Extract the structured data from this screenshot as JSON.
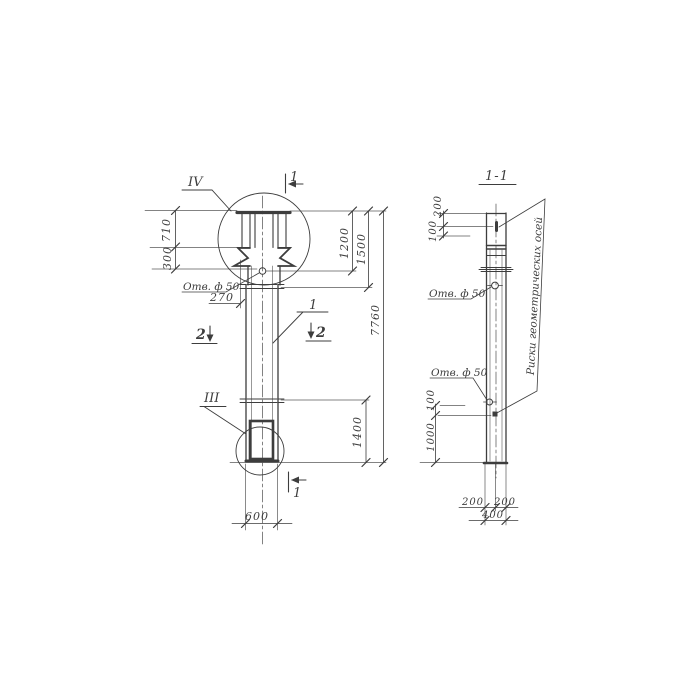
{
  "drawing": {
    "type": "engineering-drawing",
    "subject": "reinforced concrete column elevation with section",
    "colors": {
      "ink": "#3d3d3d",
      "paper": "#ffffff"
    },
    "front_view": {
      "detail_label_top": "IV",
      "detail_label_bottom": "III",
      "section_mark_1": "1",
      "section_mark_1_bottom": "1",
      "section_mark_2_left": "2",
      "section_mark_2_right": "2",
      "part_ref": "1",
      "hole_note": "Отв. ф 50",
      "dims": {
        "d710": "710",
        "d300": "300",
        "d270": "270",
        "d1200": "1200",
        "d1500": "1500",
        "d7760": "7760",
        "d1400": "1400",
        "d600": "600"
      }
    },
    "section_view": {
      "title": "1-1",
      "hole_note_upper": "Отв. ф 50",
      "hole_note_lower": "Отв. ф 50",
      "axes_note": "Риски геометрических осей",
      "dims": {
        "d200_top": "200",
        "d100_top": "100",
        "d100_low": "100",
        "d1000": "1000",
        "d200_a": "200",
        "d200_b": "200",
        "d400": "400"
      }
    }
  }
}
